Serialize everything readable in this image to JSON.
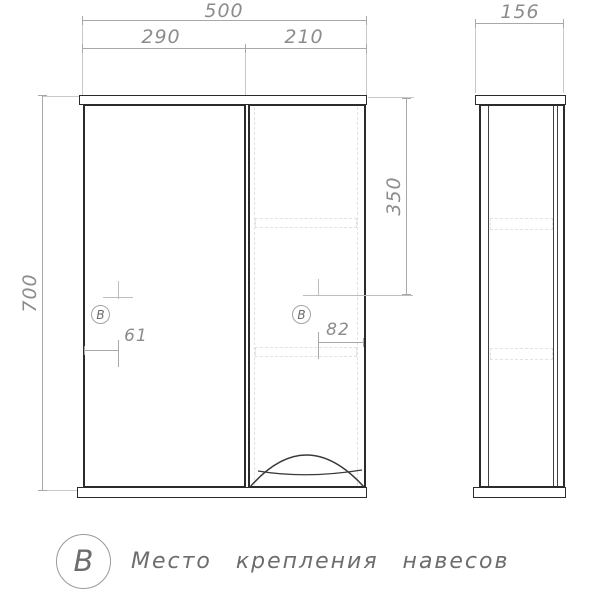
{
  "dimensions": {
    "total_width": "500",
    "left_section_width": "290",
    "right_section_width": "210",
    "height": "700",
    "mount_height": "350",
    "left_mount_offset": "61",
    "right_mount_offset": "82",
    "depth": "156"
  },
  "mount_marks": {
    "symbol": "В"
  },
  "legend": {
    "symbol": "В",
    "text": "Место крепления навесов"
  },
  "colors": {
    "outline": "#2b2b2b",
    "inner-line": "#3f3f3f",
    "dim-line": "#a8a8a8",
    "ext-line": "#c9c9c9",
    "dim-text": "#8c8c8c",
    "hidden-line": "#e2e2e2",
    "legend-text": "#6d6d6d",
    "bg": "#ffffff"
  }
}
